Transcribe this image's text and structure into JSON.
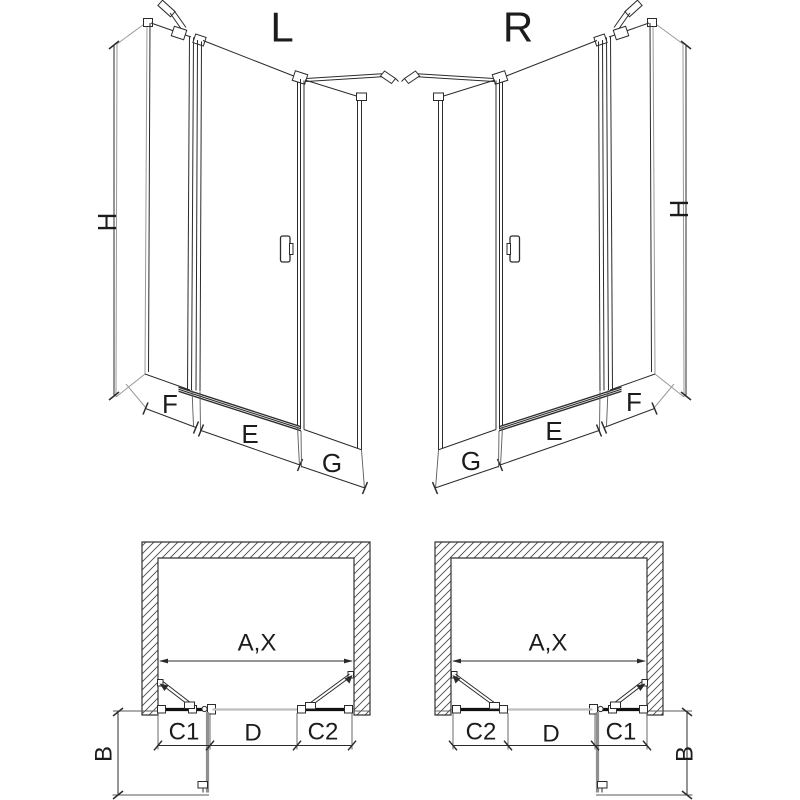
{
  "diagram_type": "shower-door installation drawing, left (L) and right (R) hinge variants",
  "views": {
    "elevation_left": {
      "title": "L",
      "height_dim": "H",
      "fixed_panel_dim": "F",
      "door_dim": "E",
      "side_panel_dim": "G"
    },
    "elevation_right": {
      "title": "R",
      "height_dim": "H",
      "fixed_panel_dim": "F",
      "door_dim": "E",
      "side_panel_dim": "G"
    },
    "plan_left": {
      "opening_dim": "A,X",
      "seg_left": "C1",
      "seg_mid": "D",
      "seg_right": "C2",
      "door_swing_dim": "B"
    },
    "plan_right": {
      "opening_dim": "A,X",
      "seg_left": "C2",
      "seg_mid": "D",
      "seg_right": "C1",
      "door_swing_dim": "B"
    }
  },
  "colors": {
    "line": "#2b2b2b",
    "light_line": "#9a9a9a",
    "open_door": "#8f8f8f",
    "opening_line": "#bdbdbd",
    "threshold": "#2e2e2e",
    "hatch": "#4a4a4a",
    "background": "#ffffff"
  }
}
